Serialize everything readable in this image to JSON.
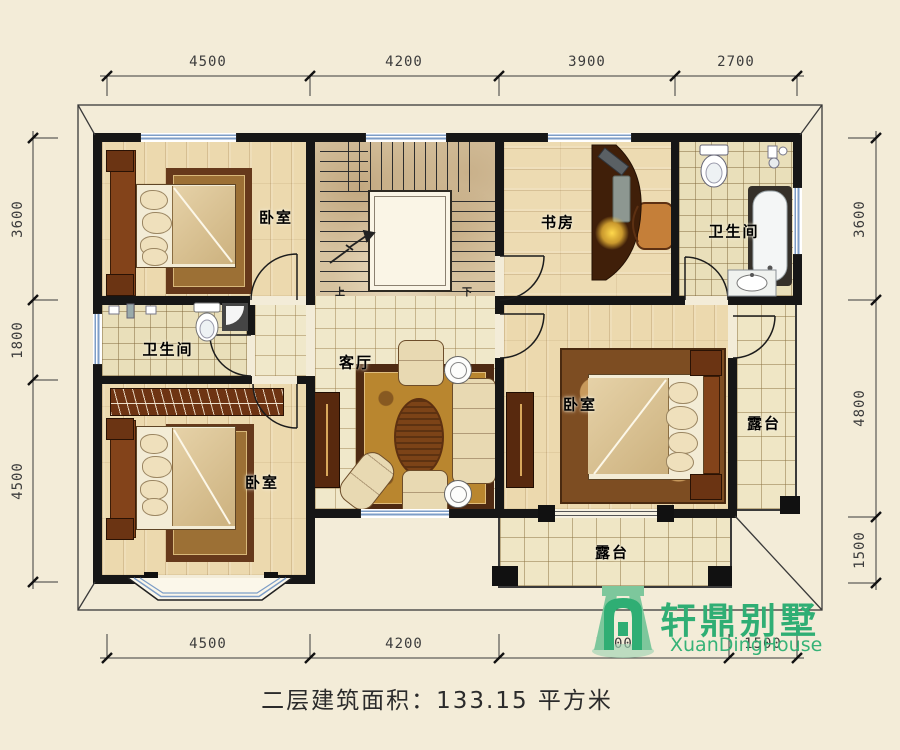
{
  "dims": {
    "top": [
      "4500",
      "4200",
      "3900",
      "2700"
    ],
    "bottom": [
      "4500",
      "4200",
      "5100",
      "1500"
    ],
    "left": [
      "3600",
      "1800",
      "4500"
    ],
    "right": [
      "3600",
      "4800",
      "1500"
    ]
  },
  "rooms": {
    "bedroom_tl": "卧室",
    "bedroom_bl": "卧室",
    "bedroom_right": "卧室",
    "study": "书房",
    "bath_top": "卫生间",
    "bath_left": "卫生间",
    "living": "客厅",
    "terrace_right": "露台",
    "terrace_bottom": "露台"
  },
  "stairs": {
    "up": "上",
    "down": "下"
  },
  "footer": {
    "area_text": "二层建筑面积：133.15 平方米"
  },
  "logo": {
    "name_cn": "轩鼎别墅",
    "name_en": "XuanDingHouse",
    "color": "#2fae74"
  },
  "colors": {
    "background": "#f3ecd8",
    "wall": "#161616",
    "window_blue": "#7e9ec7",
    "logo_green": "#2fae74"
  }
}
